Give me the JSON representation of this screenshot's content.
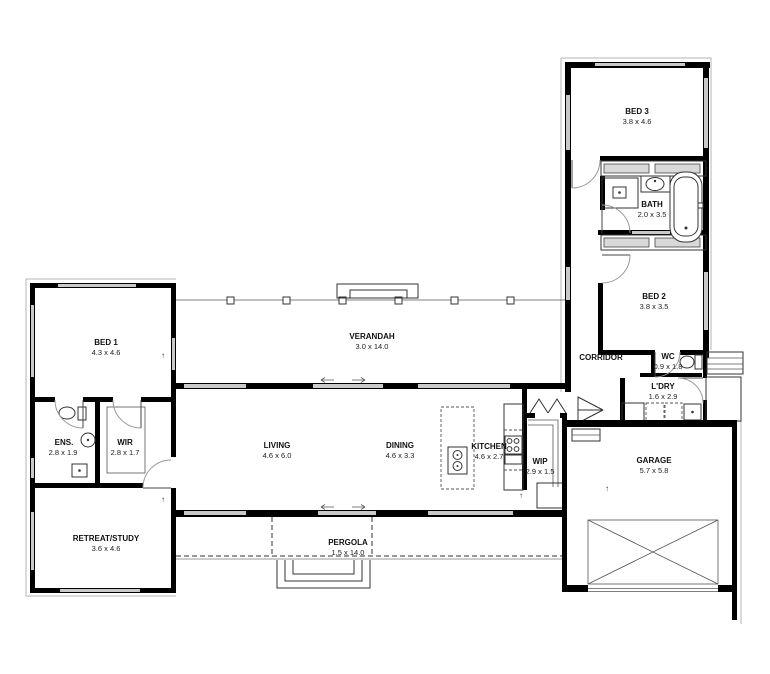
{
  "drawing": {
    "type": "residential floor plan",
    "rooms": {
      "bed1": {
        "name": "BED 1",
        "dims": "4.3 x 4.6"
      },
      "ens": {
        "name": "ENS.",
        "dims": "2.8 x 1.9"
      },
      "wir": {
        "name": "WIR",
        "dims": "2.8 x 1.7"
      },
      "retreat": {
        "name": "RETREAT/STUDY",
        "dims": "3.6 x 4.6"
      },
      "verandah": {
        "name": "VERANDAH",
        "dims": "3.0 x 14.0"
      },
      "living": {
        "name": "LIVING",
        "dims": "4.6 x 6.0"
      },
      "dining": {
        "name": "DINING",
        "dims": "4.6 x 3.3"
      },
      "kitchen": {
        "name": "KITCHEN",
        "dims": "4.6 x 2.7"
      },
      "wip": {
        "name": "WIP",
        "dims": "2.9 x 1.5"
      },
      "pergola": {
        "name": "PERGOLA",
        "dims": "1.5 x 14.0"
      },
      "bed3": {
        "name": "BED 3",
        "dims": "3.8 x 4.6"
      },
      "bath": {
        "name": "BATH",
        "dims": "2.0 x 3.5"
      },
      "bed2": {
        "name": "BED 2",
        "dims": "3.8 x 3.5"
      },
      "corridor": {
        "name": "CORRIDOR",
        "dims": ""
      },
      "wc": {
        "name": "WC",
        "dims": "0.9 x 1.8"
      },
      "ldry": {
        "name": "L'DRY",
        "dims": "1.6 x 2.9"
      },
      "garage": {
        "name": "GARAGE",
        "dims": "5.7 x 5.8"
      }
    },
    "symbols": {
      "step_marker": "↑"
    },
    "colors": {
      "wall": "#000000",
      "window": "#c9c9c9",
      "door_arc": "#999999",
      "label": "#111111"
    }
  }
}
